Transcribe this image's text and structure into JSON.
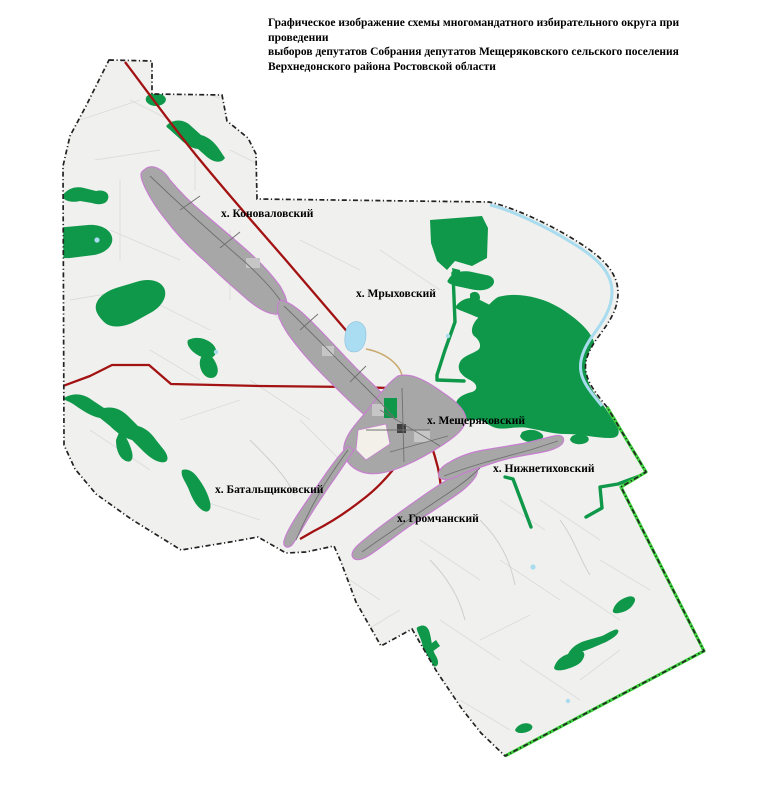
{
  "title": {
    "line1": "Графическое изображение схемы многомандатного избирательного округа при проведении",
    "line2": "выборов депутатов Собрания депутатов Мещеряковского сельского поселения",
    "line3": "Верхнедонского района Ростовской области"
  },
  "map": {
    "labels": [
      {
        "text": "х. Коноваловский"
      },
      {
        "text": "х. Мрыховский"
      },
      {
        "text": "х. Мещеряковский"
      },
      {
        "text": "х. Нижнетиховский"
      },
      {
        "text": "х. Батальщиковский"
      },
      {
        "text": "х. Громчанский"
      }
    ],
    "colors": {
      "territory_fill": "#f0f0ee",
      "forest_green": "#10984a",
      "settlement_gray": "#a7a7a7",
      "settlement_outline": "#c77fd0",
      "road_red": "#a21212",
      "road_tan": "#c9a86d",
      "water_blue": "#a8dcee",
      "boundary_black": "#222222",
      "boundary_green": "#3dd13d",
      "building_dark": "#3f3f3f"
    }
  }
}
